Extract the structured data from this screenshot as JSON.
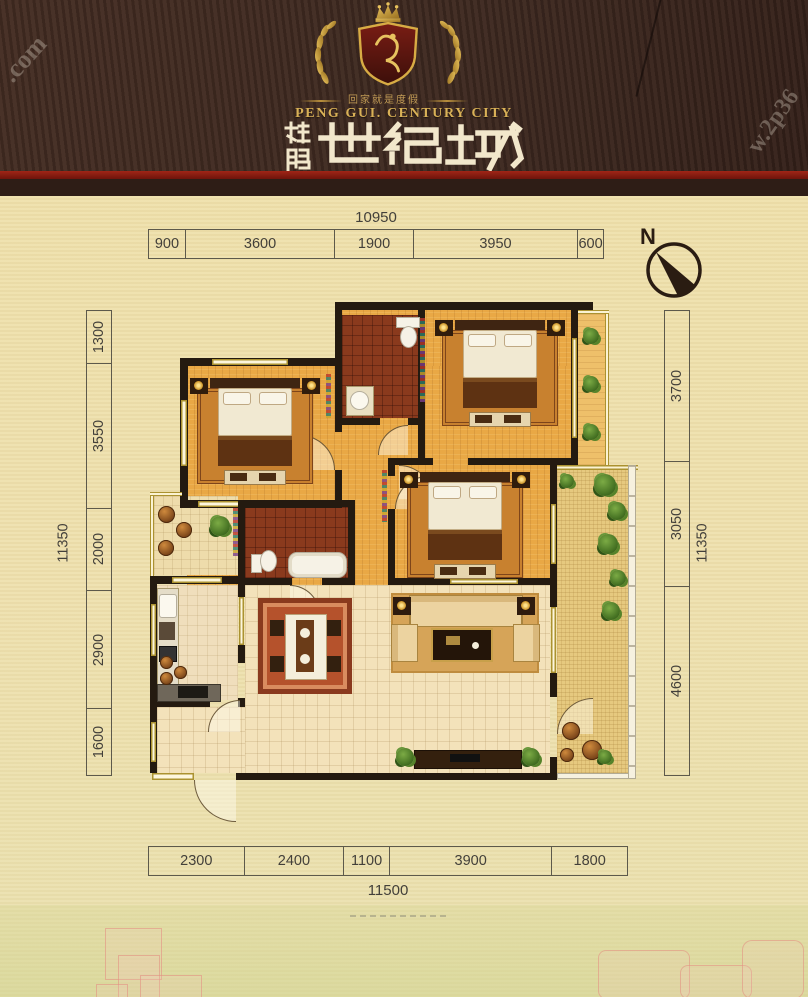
{
  "header": {
    "tagline": "回家就是度假",
    "brand_en": "PENG GUI. CENTURY CITY",
    "brand_cn_prefix": "桂鹏",
    "brand_cn_main": "世纪城",
    "brand_cn_full": "桂鹏世纪城"
  },
  "watermarks": {
    "top_left": ".com",
    "right_edge": "w.2p36"
  },
  "compass": {
    "north_label": "N"
  },
  "plan_dimensions": {
    "top": {
      "total": "10950",
      "segments": [
        "900",
        "3600",
        "1900",
        "3950",
        "600"
      ]
    },
    "bottom": {
      "total": "11500",
      "segments": [
        "2300",
        "2400",
        "1100",
        "3900",
        "1800"
      ]
    },
    "left": {
      "total": "11350",
      "segments": [
        "1300",
        "3550",
        "2000",
        "2900",
        "1600"
      ]
    },
    "right": {
      "total": "11350",
      "segments": [
        "3700",
        "3050",
        "4600"
      ]
    }
  },
  "colors": {
    "header_bg": "#3f2a21",
    "gold": "#d2a741",
    "title_text": "#f4ead2",
    "accent_red": "#8a1f12",
    "wall": "#241a10",
    "wood": "#e9a845",
    "tile_dark": "#8a3a1d",
    "tile_cream": "#f3e2ba"
  }
}
